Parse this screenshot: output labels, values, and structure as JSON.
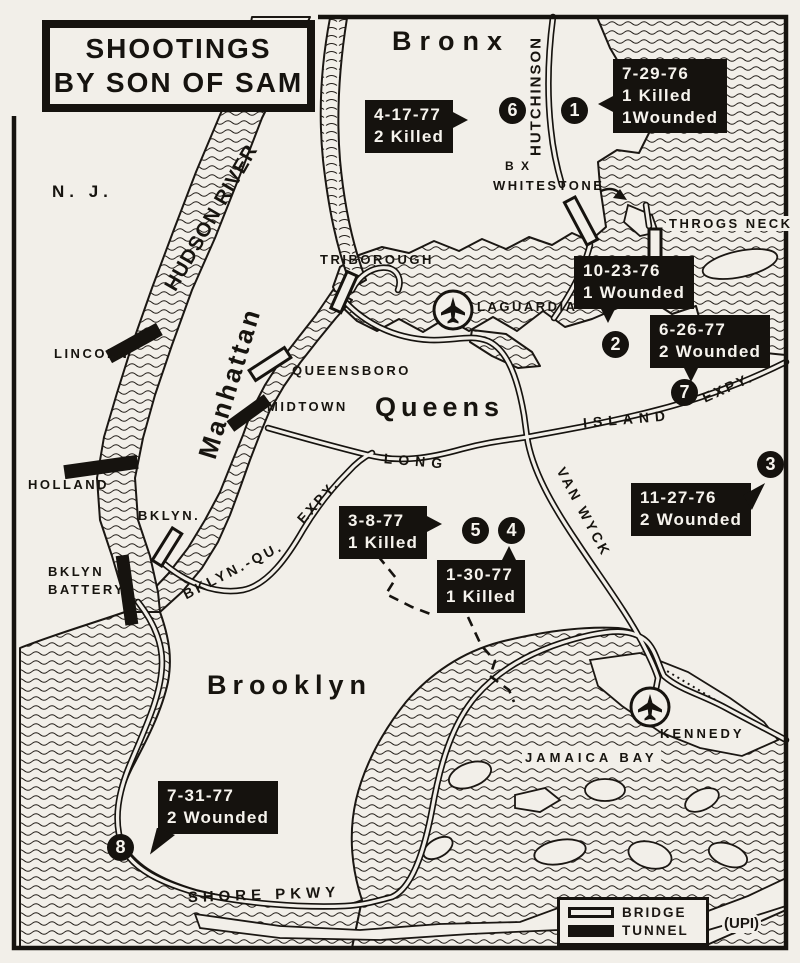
{
  "title": {
    "line1": "SHOOTINGS",
    "line2": "BY SON OF SAM"
  },
  "places": {
    "nj": "N. J.",
    "bronx": "Bronx",
    "manhattan": "Manhattan",
    "queens": "Queens",
    "brooklyn": "Brooklyn"
  },
  "waters": {
    "hudson": "HUDSON RIVER",
    "jamaica_bay": "JAMAICA BAY"
  },
  "airports": {
    "laguardia": "LAGUARDIA",
    "kennedy": "KENNEDY"
  },
  "roads": {
    "hutchinson": "HUTCHINSON",
    "long": "LONG",
    "island": "ISLAND",
    "island_expy": "EXPY.",
    "van_wyck": "VAN WYCK",
    "bklyn_qu": "BKLYN.-QU.",
    "bklyn_qu_expy": "EXPY.",
    "shore_pkwy": "SHORE PKWY"
  },
  "crossings": {
    "lincoln": "LINCOLN",
    "holland": "HOLLAND",
    "bklyn": "BKLYN.",
    "battery1": "BKLYN",
    "battery2": "BATTERY",
    "triborough": "TRIBOROUGH",
    "queensboro": "QUEENSBORO",
    "midtown": "MIDTOWN",
    "bx": "B X",
    "whitestone": "WHITESTONE",
    "throgs_neck": "THROGS NECK"
  },
  "events": [
    {
      "num": "1",
      "date": "7-29-76",
      "lines": [
        "1 Killed",
        "1Wounded"
      ]
    },
    {
      "num": "2",
      "date": "10-23-76",
      "lines": [
        "1 Wounded"
      ]
    },
    {
      "num": "3",
      "date": "11-27-76",
      "lines": [
        "2 Wounded"
      ]
    },
    {
      "num": "4",
      "date": "1-30-77",
      "lines": [
        "1 Killed"
      ]
    },
    {
      "num": "5",
      "date": "3-8-77",
      "lines": [
        "1 Killed"
      ]
    },
    {
      "num": "6",
      "date": "4-17-77",
      "lines": [
        "2 Killed"
      ]
    },
    {
      "num": "7",
      "date": "6-26-77",
      "lines": [
        "2 Wounded"
      ]
    },
    {
      "num": "8",
      "date": "7-31-77",
      "lines": [
        "2 Wounded"
      ]
    }
  ],
  "legend": {
    "bridge": "BRIDGE",
    "tunnel": "TUNNEL",
    "credit": "(UPI)"
  }
}
